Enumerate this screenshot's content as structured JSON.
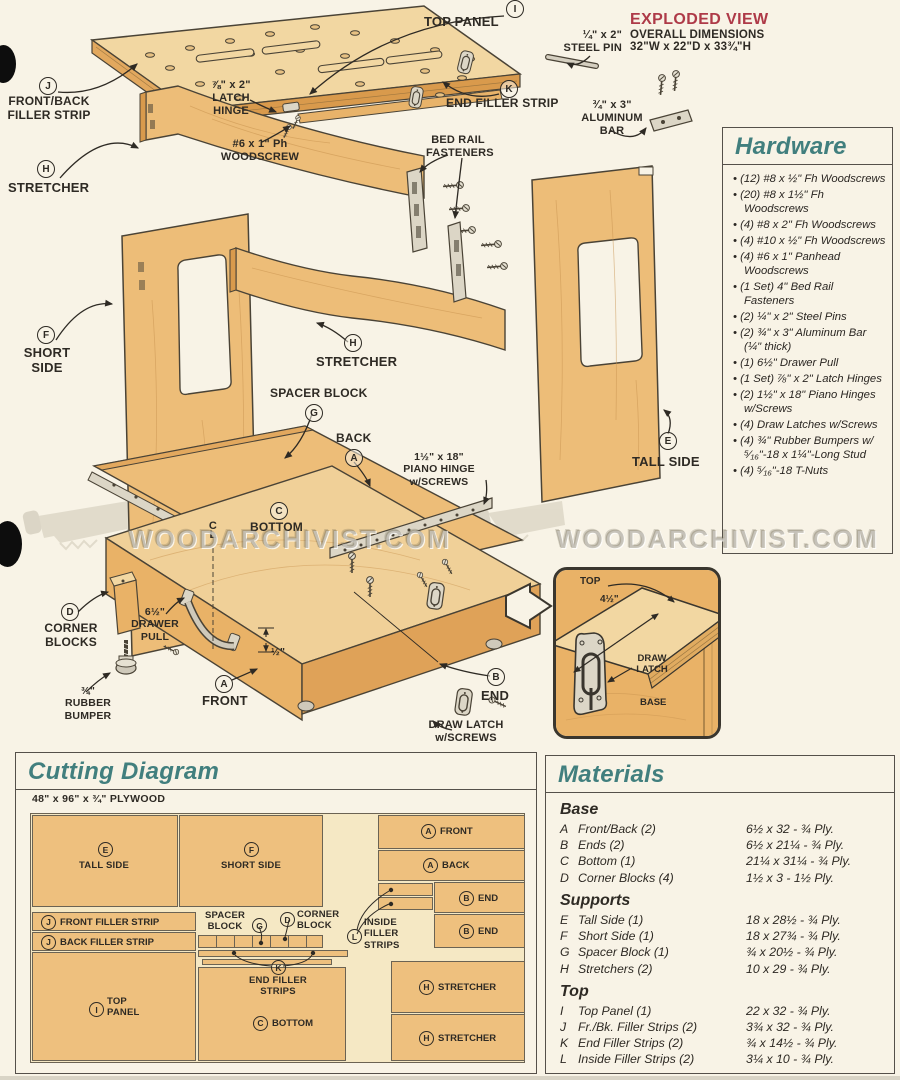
{
  "colors": {
    "teal": "#417f7e",
    "red": "#ae3a48",
    "wood": "#edbd78",
    "wood_light": "#f2d7a2",
    "cream": "#f8f3e6"
  },
  "exploded": {
    "title_red": "EXPLODED VIEW",
    "title_line2": "OVERALL DIMENSIONS",
    "title_line3": "32\"W x 22\"D x 33¾\"H",
    "watermark": "WOODARCHIVIST.COM",
    "labels": {
      "top_panel": {
        "letter": "I",
        "text": "TOP PANEL"
      },
      "steel_pin": {
        "text": "¼\" x 2\"\nSTEEL PIN"
      },
      "end_filler": {
        "letter": "K",
        "text": "END FILLER STRIP"
      },
      "latch_hinge": {
        "text": "⅞\" x 2\"\nLATCH HINGE"
      },
      "front_back_filler": {
        "letter": "J",
        "text": "FRONT/BACK\nFILLER STRIP"
      },
      "woodscrew": {
        "text": "#6 x 1\" Ph\nWOODSCREW"
      },
      "stretcher_left": {
        "letter": "H",
        "text": "STRETCHER"
      },
      "bed_rail": {
        "text": "BED RAIL\nFASTENERS"
      },
      "aluminum_bar": {
        "text": "¾\" x 3\"\nALUMINUM\nBAR"
      },
      "short_side": {
        "letter": "F",
        "text": "SHORT\nSIDE"
      },
      "stretcher_mid": {
        "letter": "H",
        "text": "STRETCHER"
      },
      "spacer_block": {
        "letter": "G",
        "text": "SPACER BLOCK"
      },
      "back": {
        "letter": "A",
        "text": "BACK"
      },
      "piano_hinge": {
        "text": "1½\" x 18\"\nPIANO HINGE\nw/SCREWS"
      },
      "tall_side": {
        "letter": "E",
        "text": "TALL SIDE"
      },
      "bottom": {
        "letter": "C",
        "text": "BOTTOM"
      },
      "centerline": {
        "text": "C\nL"
      },
      "corner_blocks": {
        "letter": "D",
        "text": "CORNER\nBLOCKS"
      },
      "drawer_pull": {
        "text": "6½\"\nDRAWER\nPULL"
      },
      "rubber_bumper": {
        "text": "¾\"\nRUBBER\nBUMPER"
      },
      "half_dim": {
        "text": "½\""
      },
      "front": {
        "letter": "A",
        "text": "FRONT"
      },
      "end": {
        "letter": "B",
        "text": "END"
      },
      "draw_latch": {
        "text": "DRAW LATCH\nw/SCREWS"
      }
    },
    "inset": {
      "top": "TOP",
      "dim": "4½\"",
      "latch": "DRAW\nLATCH",
      "base": "BASE"
    }
  },
  "hardware": {
    "title": "Hardware",
    "items": [
      "(12) #8 x ½\" Fh Woodscrews",
      "(20) #8 x 1½\" Fh Woodscrews",
      "(4) #8 x 2\" Fh Woodscrews",
      "(4) #10 x ½\" Fh Woodscrews",
      "(4) #6 x 1\" Panhead Woodscrews",
      "(1 Set) 4\" Bed Rail Fasteners",
      "(2) ¼\" x 2\" Steel Pins",
      "(2) ¾\" x 3\" Aluminum Bar (¼\" thick)",
      "(1) 6½\" Drawer Pull",
      "(1 Set) ⅞\" x 2\" Latch Hinges",
      "(2) 1½\" x 18\" Piano Hinges w/Screws",
      "(4) Draw Latches w/Screws",
      "(4) ¾\" Rubber Bumpers w/⁵⁄₁₆\"-18 x 1¼\"-Long Stud",
      "(4) ⁵⁄₁₆\"-18 T-Nuts"
    ]
  },
  "cutting": {
    "title": "Cutting Diagram",
    "sheet_label": "48\" x 96\" x ¾\" PLYWOOD",
    "pieces": {
      "tall_side": {
        "letter": "E",
        "name": "TALL SIDE"
      },
      "short_side": {
        "letter": "F",
        "name": "SHORT SIDE"
      },
      "front": {
        "letter": "A",
        "name": "FRONT"
      },
      "back": {
        "letter": "A",
        "name": "BACK"
      },
      "end1": {
        "letter": "B",
        "name": "END"
      },
      "end2": {
        "letter": "B",
        "name": "END"
      },
      "front_filler": {
        "letter": "J",
        "name": "FRONT FILLER STRIP"
      },
      "back_filler": {
        "letter": "J",
        "name": "BACK FILLER STRIP"
      },
      "spacer_block": {
        "letter": "G",
        "name": "SPACER\nBLOCK"
      },
      "corner_block": {
        "letter": "D",
        "name": "CORNER\nBLOCK"
      },
      "inside_filler": {
        "letter": "L",
        "name": "INSIDE\nFILLER\nSTRIPS"
      },
      "end_filler": {
        "letter": "K",
        "name": "END FILLER\nSTRIPS"
      },
      "top_panel": {
        "letter": "I",
        "name": "TOP\nPANEL"
      },
      "bottom": {
        "letter": "C",
        "name": "BOTTOM"
      },
      "stretcher1": {
        "letter": "H",
        "name": "STRETCHER"
      },
      "stretcher2": {
        "letter": "H",
        "name": "STRETCHER"
      }
    }
  },
  "materials": {
    "title": "Materials",
    "sections": [
      {
        "name": "Base",
        "rows": [
          {
            "letter": "A",
            "name": "Front/Back (2)",
            "dims": "6½ x 32 - ¾ Ply."
          },
          {
            "letter": "B",
            "name": "Ends (2)",
            "dims": "6½ x 21¼ - ¾ Ply."
          },
          {
            "letter": "C",
            "name": "Bottom (1)",
            "dims": "21¼ x 31¼ - ¾ Ply."
          },
          {
            "letter": "D",
            "name": "Corner Blocks (4)",
            "dims": "1½ x 3 - 1½ Ply."
          }
        ]
      },
      {
        "name": "Supports",
        "rows": [
          {
            "letter": "E",
            "name": "Tall Side (1)",
            "dims": "18 x 28½ - ¾ Ply."
          },
          {
            "letter": "F",
            "name": "Short Side (1)",
            "dims": "18 x 27¾ - ¾ Ply."
          },
          {
            "letter": "G",
            "name": "Spacer Block (1)",
            "dims": "¾ x 20½ - ¾ Ply."
          },
          {
            "letter": "H",
            "name": "Stretchers (2)",
            "dims": "10 x 29 - ¾ Ply."
          }
        ]
      },
      {
        "name": "Top",
        "rows": [
          {
            "letter": "I",
            "name": "Top Panel (1)",
            "dims": "22 x 32 - ¾ Ply."
          },
          {
            "letter": "J",
            "name": "Fr./Bk. Filler Strips (2)",
            "dims": "3¾ x 32 - ¾ Ply."
          },
          {
            "letter": "K",
            "name": "End Filler Strips (2)",
            "dims": "¾ x 14½ - ¾ Ply."
          },
          {
            "letter": "L",
            "name": "Inside Filler Strips (2)",
            "dims": "3¼ x 10 - ¾ Ply."
          }
        ]
      }
    ]
  }
}
